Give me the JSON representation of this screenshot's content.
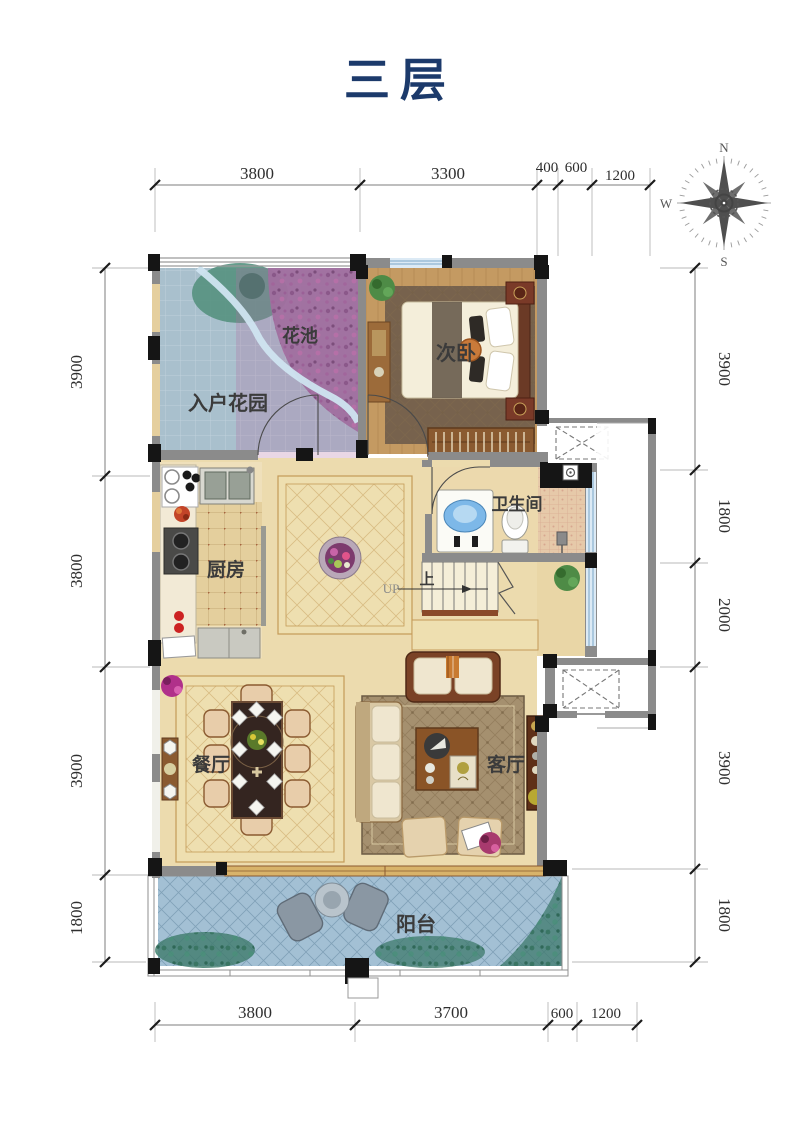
{
  "page": {
    "title": "三层"
  },
  "compass": {
    "n": "N",
    "w": "W",
    "s": "S"
  },
  "rooms": {
    "flower_bed": "花池",
    "entry_garden": "入户花园",
    "bedroom": "次卧",
    "bathroom": "卫生间",
    "kitchen": "厨房",
    "dining": "餐厅",
    "living": "客厅",
    "balcony": "阳台",
    "stairs_up": "上",
    "stairs_up_en": "UP"
  },
  "dimensions": {
    "top": [
      "3800",
      "3300",
      "400",
      "600",
      "1200"
    ],
    "bottom": [
      "3800",
      "3700",
      "600",
      "1200"
    ],
    "left": [
      "3900",
      "3800",
      "3900",
      "1800"
    ],
    "right": [
      "3900",
      "1800",
      "2000",
      "3900",
      "1800"
    ]
  },
  "colors": {
    "title_navy": "#1c3a6b",
    "marble_floor": "#e9d6a6",
    "garden_blue": "#a9c0cd",
    "flower_purple": "#9b6f9e",
    "balcony_blue": "#a3c0d4",
    "wall_gray": "#8b8b8b",
    "column_black": "#151515"
  }
}
